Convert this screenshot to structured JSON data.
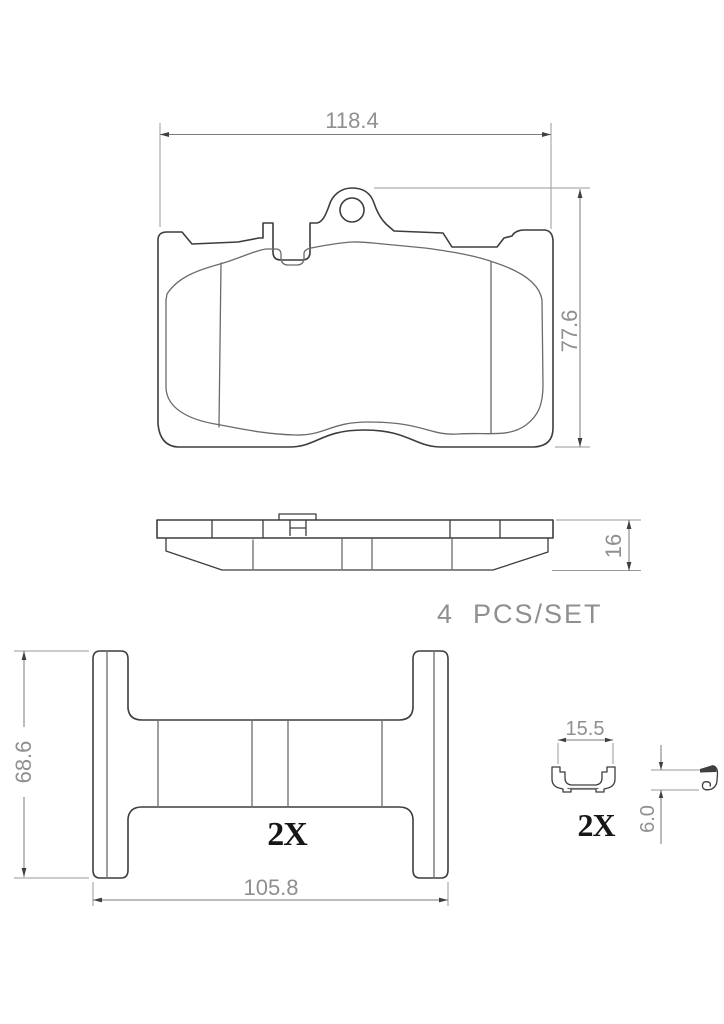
{
  "drawing": {
    "kind": "brake-pad-technical-drawing",
    "views": {
      "pad_front": {
        "width_dim": "118.4",
        "height_dim": "77.6"
      },
      "pad_side": {
        "thickness_dim": "16"
      },
      "set_note": "4  PCS/SET",
      "shim": {
        "height_dim": "68.6",
        "width_dim": "105.8",
        "quantity_label": "2X"
      },
      "clip": {
        "width_dim": "15.5",
        "height_dim": "6.0",
        "quantity_label": "2X"
      }
    },
    "colors": {
      "background": "#ffffff",
      "part_outline": "#3d3d3d",
      "friction_outline": "#6b6b6b",
      "dimension_line": "#7a7a7a",
      "extension_line": "#9a9a9a",
      "dimension_text": "#8f8f8f",
      "quantity_text": "#161616"
    }
  }
}
